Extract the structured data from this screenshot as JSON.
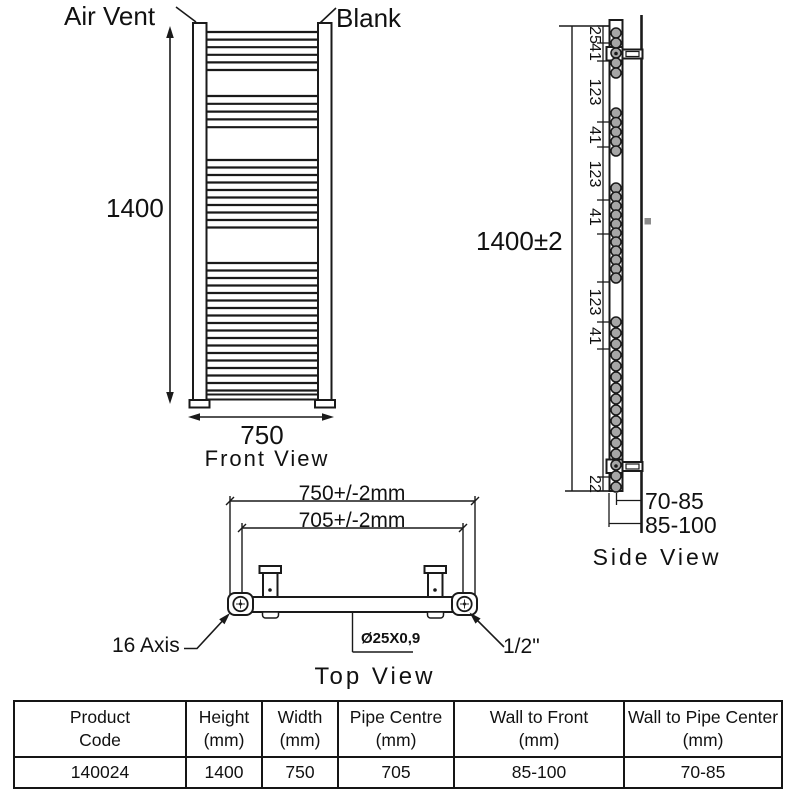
{
  "drawing": {
    "front_view": {
      "caption": "Front View",
      "air_vent_label": "Air Vent",
      "blank_label": "Blank",
      "height_dim": "1400",
      "width_dim": "750",
      "bar_groups": [
        6,
        5,
        10,
        18
      ]
    },
    "side_view": {
      "caption": "Side View",
      "overall_height_dim": "1400±2",
      "spacing_dims": [
        "25",
        "41",
        "123",
        "41",
        "123",
        "41",
        "123",
        "41"
      ],
      "bottom_spacing_dim": "22",
      "wall_to_pipe_dim": "70-85",
      "wall_to_front_dim": "85-100",
      "tube_groups": [
        5,
        5,
        11,
        16
      ]
    },
    "top_view": {
      "caption": "Top View",
      "outer_width_dim": "750+/-2mm",
      "pipe_centre_dim": "705+/-2mm",
      "axis_label": "16 Axis",
      "pipe_spec_label": "Ø25X0,9",
      "connection_label": "1/2\""
    }
  },
  "table": {
    "headers": [
      {
        "line1": "Product",
        "line2": "Code"
      },
      {
        "line1": "Height",
        "line2": "(mm)"
      },
      {
        "line1": "Width",
        "line2": "(mm)"
      },
      {
        "line1": "Pipe Centre",
        "line2": "(mm)"
      },
      {
        "line1": "Wall to Front",
        "line2": "(mm)"
      },
      {
        "line1": "Wall to Pipe Center",
        "line2": "(mm)"
      }
    ],
    "row": {
      "product_code": "140024",
      "height": "1400",
      "width": "750",
      "pipe_centre": "705",
      "wall_to_front": "85-100",
      "wall_to_pipe_center": "70-85"
    }
  },
  "colors": {
    "line": "#1a1a1a",
    "tube_fill": "#a6a6a6",
    "wall_mark": "#8c8c8c",
    "background": "#ffffff"
  }
}
